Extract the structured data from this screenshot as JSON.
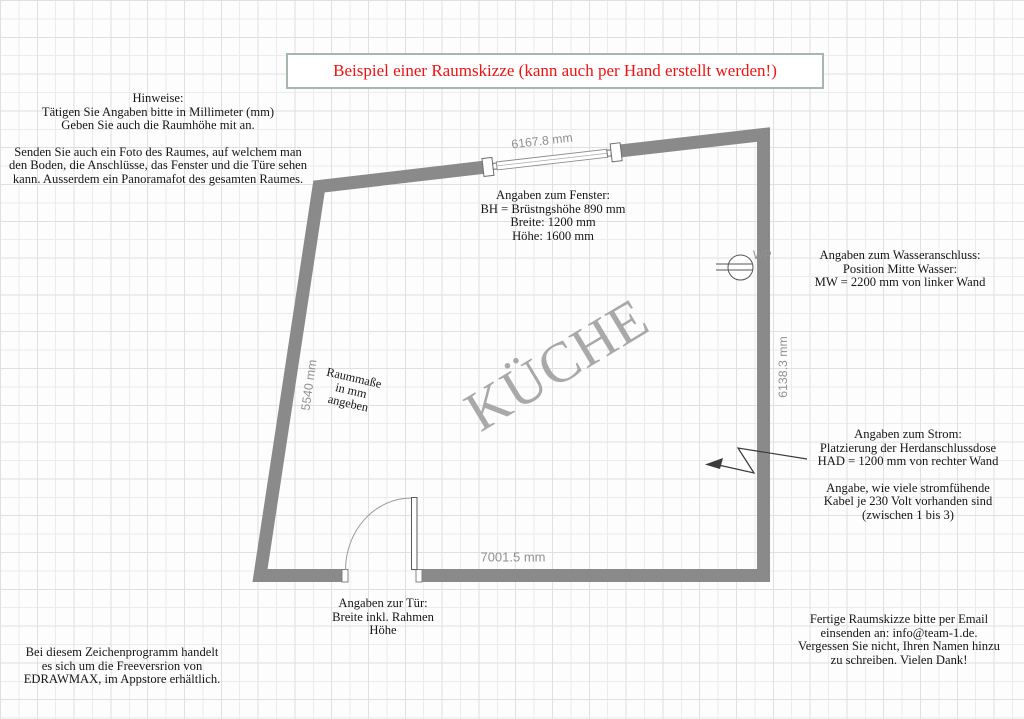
{
  "title_box": {
    "text": "Beispiel einer Raumskizze (kann auch per Hand erstellt werden!)"
  },
  "notes": {
    "hinweise": [
      "Hinweise:",
      "Tätigen Sie Angaben bitte in Millimeter (mm)",
      "Geben Sie auch die Raumhöhe mit an.",
      "Senden Sie auch ein Foto des Raumes, auf welchem man",
      "den Boden, die Anschlüsse, das Fenster und die Türe sehen",
      "kann. Ausserdem ein Panoramafot des gesamten Raumes."
    ],
    "fenster": [
      "Angaben zum Fenster:",
      "BH = Brüstngshöhe 890 mm",
      "Breite: 1200 mm",
      "Höhe: 1600 mm"
    ],
    "wasser": [
      "Angaben zum Wasseranschluss:",
      "Position Mitte Wasser:",
      "MW = 2200 mm von linker Wand"
    ],
    "strom_a": [
      "Angaben zum Strom:",
      "Platzierung der Herdanschlussdose",
      "HAD = 1200 mm von rechter Wand"
    ],
    "strom_b": [
      "Angabe, wie viele stromfühende",
      "Kabel je 230 Volt vorhanden sind",
      "(zwischen 1 bis 3)"
    ],
    "tuer": [
      "Angaben zur Tür:",
      "Breite inkl. Rahmen",
      "Höhe"
    ],
    "email": [
      "Fertige Raumskizze bitte per Email",
      "einsenden an: info@team-1.de.",
      "Vergessen Sie nicht, Ihren Namen hinzu",
      "zu schreiben. Vielen Dank!"
    ],
    "programm": [
      "Bei diesem Zeichenprogramm handelt",
      "es sich um die Freeversrion von",
      "EDRAWMAX, im Appstore erhältlich."
    ]
  },
  "room": {
    "label": "KÜCHE",
    "raummasse": [
      "Raummaße",
      "in mm",
      "angeben"
    ],
    "dimensions": {
      "top_wall": "6167.8 mm",
      "left_wall": "5540 mm",
      "right_wall": "6138.3 mm",
      "bottom_wall": "7001.5 mm"
    },
    "water_label": "WP"
  },
  "colors": {
    "wall": "#8a8a8a",
    "dim-text": "#909090",
    "room-label": "#a9a9a9",
    "title-red": "#f21212",
    "title-border": "#a7b7ab",
    "body-text": "#161616",
    "grid-line": "#ececec",
    "grid-line-major": "#e0e0e0",
    "canvas-bg": "#fdfdfd"
  }
}
